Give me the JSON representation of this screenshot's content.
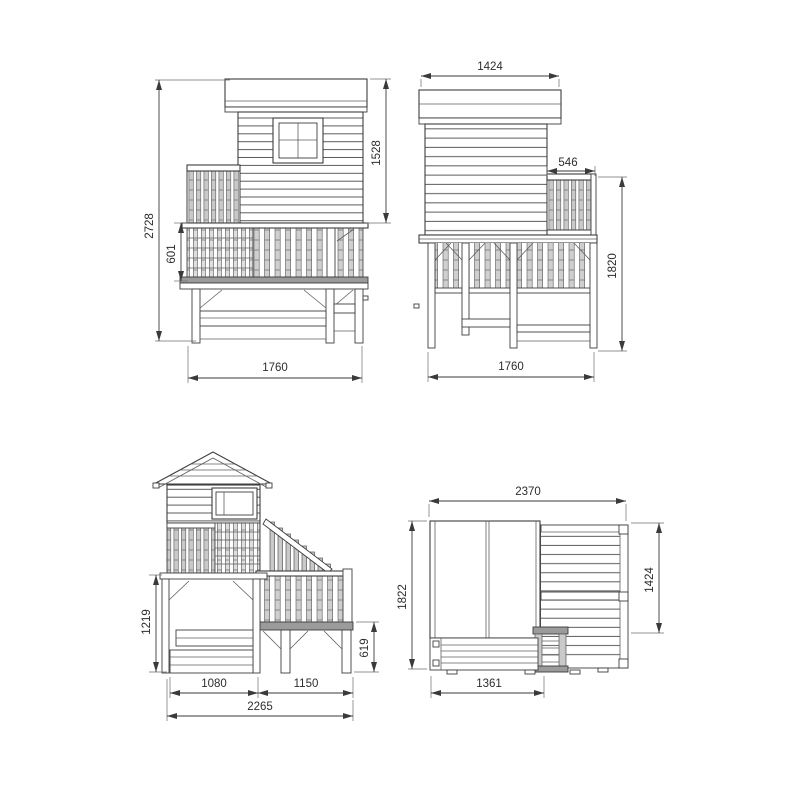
{
  "page": {
    "background": "#ffffff"
  },
  "drawing": {
    "stroke_color": "#3e3e3e",
    "dimension_text_color": "#2d2d2d",
    "slat_fill": "#c9c9c9",
    "deck_fill": "#9b9b9b",
    "views": {
      "side_left": {
        "dims": {
          "overall_height": "2728",
          "balustrade_height": "601",
          "house_height": "1528",
          "base_width": "1760"
        }
      },
      "side_right": {
        "dims": {
          "roof_width": "1424",
          "balcony_depth": "546",
          "height_to_deck": "1820",
          "base_width": "1760"
        }
      },
      "front": {
        "dims": {
          "tower_height": "1219",
          "tower_width": "1080",
          "stair_span": "1150",
          "overall_width": "2265",
          "landing_height": "619"
        }
      },
      "plan": {
        "dims": {
          "overall_width": "2370",
          "overall_depth": "1822",
          "terrace_depth": "1424",
          "sandbox_width": "1361"
        }
      }
    }
  }
}
